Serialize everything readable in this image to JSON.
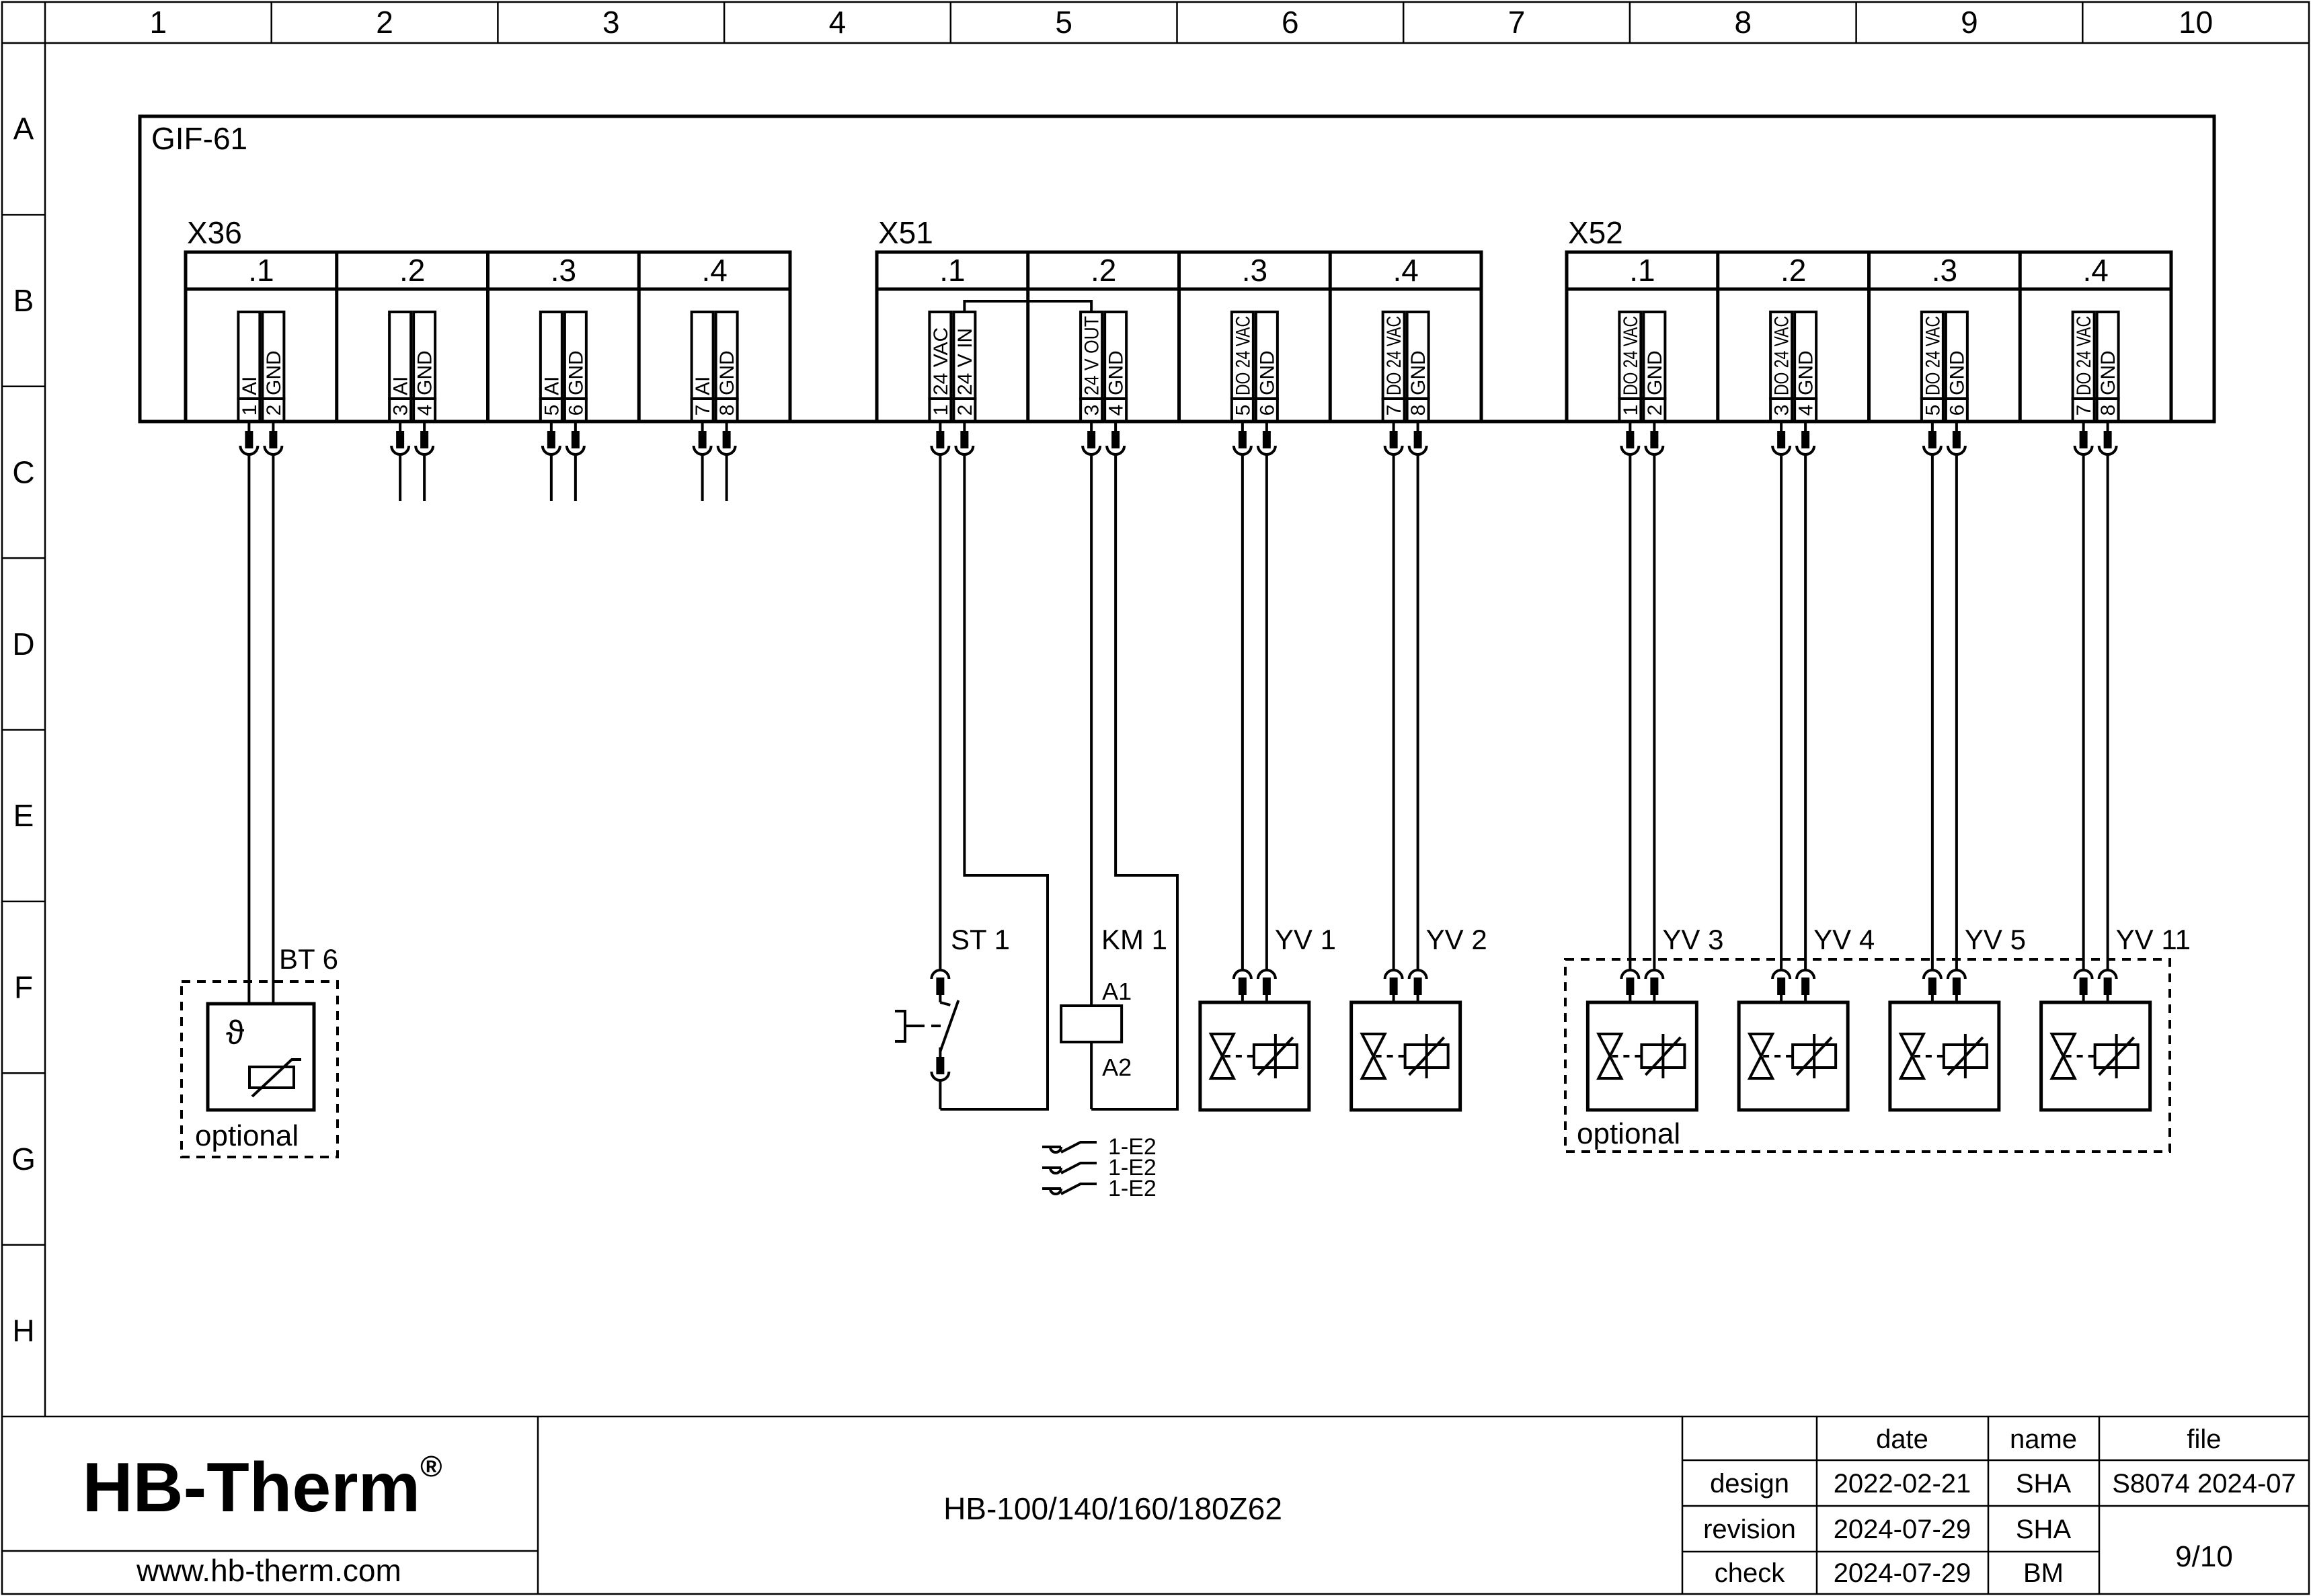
{
  "rulers": {
    "cols": [
      "1",
      "2",
      "3",
      "4",
      "5",
      "6",
      "7",
      "8",
      "9",
      "10"
    ],
    "rows": [
      "A",
      "B",
      "C",
      "D",
      "E",
      "F",
      "G",
      "H"
    ]
  },
  "main_device": {
    "label": "GIF-61"
  },
  "connectors": [
    {
      "label": "X36",
      "sections": [
        {
          "label": ".1",
          "pins": [
            {
              "no": "1",
              "signal": "AI"
            },
            {
              "no": "2",
              "signal": "GND"
            }
          ]
        },
        {
          "label": ".2",
          "pins": [
            {
              "no": "3",
              "signal": "AI"
            },
            {
              "no": "4",
              "signal": "GND"
            }
          ]
        },
        {
          "label": ".3",
          "pins": [
            {
              "no": "5",
              "signal": "AI"
            },
            {
              "no": "6",
              "signal": "GND"
            }
          ]
        },
        {
          "label": ".4",
          "pins": [
            {
              "no": "7",
              "signal": "AI"
            },
            {
              "no": "8",
              "signal": "GND"
            }
          ]
        }
      ]
    },
    {
      "label": "X51",
      "sections": [
        {
          "label": ".1",
          "pins": [
            {
              "no": "1",
              "signal": "24 VAC"
            },
            {
              "no": "2",
              "signal": "24 V IN"
            }
          ]
        },
        {
          "label": ".2",
          "pins": [
            {
              "no": "3",
              "signal": "24 V OUT"
            },
            {
              "no": "4",
              "signal": "GND"
            }
          ]
        },
        {
          "label": ".3",
          "pins": [
            {
              "no": "5",
              "signal": "DO 24 VAC"
            },
            {
              "no": "6",
              "signal": "GND"
            }
          ]
        },
        {
          "label": ".4",
          "pins": [
            {
              "no": "7",
              "signal": "DO 24 VAC"
            },
            {
              "no": "8",
              "signal": "GND"
            }
          ]
        }
      ]
    },
    {
      "label": "X52",
      "sections": [
        {
          "label": ".1",
          "pins": [
            {
              "no": "1",
              "signal": "DO 24 VAC"
            },
            {
              "no": "2",
              "signal": "GND"
            }
          ]
        },
        {
          "label": ".2",
          "pins": [
            {
              "no": "3",
              "signal": "DO 24 VAC"
            },
            {
              "no": "4",
              "signal": "GND"
            }
          ]
        },
        {
          "label": ".3",
          "pins": [
            {
              "no": "5",
              "signal": "DO 24 VAC"
            },
            {
              "no": "6",
              "signal": "GND"
            }
          ]
        },
        {
          "label": ".4",
          "pins": [
            {
              "no": "7",
              "signal": "DO 24 VAC"
            },
            {
              "no": "8",
              "signal": "GND"
            }
          ]
        }
      ]
    }
  ],
  "components": {
    "bt6": {
      "label": "BT 6",
      "symbol": "ϑ",
      "note": "optional"
    },
    "st1": {
      "label": "ST 1"
    },
    "km1": {
      "label": "KM 1",
      "a1": "A1",
      "a2": "A2"
    },
    "contacts": [
      {
        "ref": "1-E2"
      },
      {
        "ref": "1-E2"
      },
      {
        "ref": "1-E2"
      }
    ],
    "valves": [
      {
        "label": "YV 1"
      },
      {
        "label": "YV 2"
      },
      {
        "label": "YV 3"
      },
      {
        "label": "YV 4"
      },
      {
        "label": "YV 5"
      },
      {
        "label": "YV 11"
      }
    ],
    "valve_optional_note": "optional"
  },
  "title_block": {
    "logo": "HB-Therm",
    "logo_reg": "®",
    "logo_color": "#242e49",
    "website": "www.hb-therm.com",
    "model": "HB-100/140/160/180Z62",
    "table": {
      "date_header": "date",
      "name_header": "name",
      "file_header": "file",
      "rows": [
        {
          "label": "design",
          "date": "2022-02-21",
          "name": "SHA"
        },
        {
          "label": "revision",
          "date": "2024-07-29",
          "name": "SHA"
        },
        {
          "label": "check",
          "date": "2024-07-29",
          "name": "BM"
        }
      ],
      "file_value": "S8074 2024-07",
      "page": "9/10"
    }
  }
}
